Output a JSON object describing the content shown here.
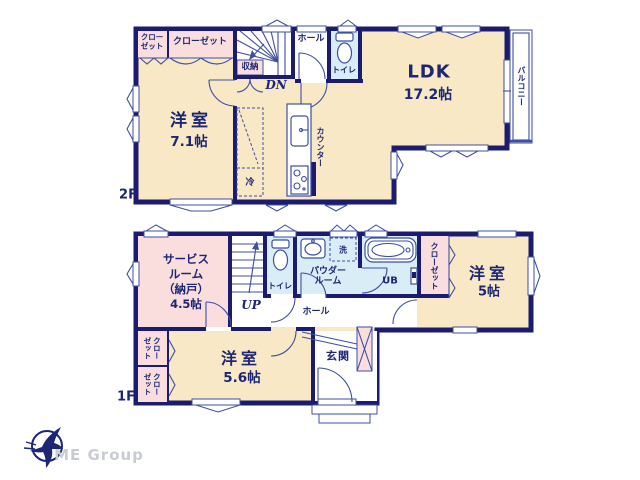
{
  "colors": {
    "wall": "#1b1b70",
    "cream": "#f8e8c6",
    "pink": "#fadede",
    "blue": "#d9edf6",
    "line": "#3d4fa1",
    "text": "#1c2674",
    "logo_gray": "#c9cdd3"
  },
  "floor2": {
    "label": "2F",
    "closet_small": "クロー\nゼット",
    "closet_large": "クローゼット",
    "storage": "収納",
    "stairs_dir": "DN",
    "hall": "ホール",
    "toilet": "トイレ",
    "ldk_name": "LDK",
    "ldk_size": "17.2帖",
    "room_name": "洋室",
    "room_size": "7.1帖",
    "counter": "カウンター",
    "fridge": "冷",
    "balcony": "バルコニー"
  },
  "floor1": {
    "label": "1F",
    "service_room": "サービス\nルーム\n（納戸）\n4.5帖",
    "stairs_dir": "UP",
    "toilet": "トイレ",
    "washer": "洗",
    "powder_room": "パウダー\nルーム",
    "bath": "UB",
    "closet_right": "クローゼット",
    "room5_name": "洋室",
    "room5_size": "5帖",
    "hall": "ホール",
    "entrance": "玄関",
    "room56_name": "洋室",
    "room56_size": "5.6帖",
    "closet_bottom_1": "クロー\nゼット",
    "closet_bottom_2": "クロー\nゼット"
  },
  "logo": {
    "company": "ME Group"
  }
}
